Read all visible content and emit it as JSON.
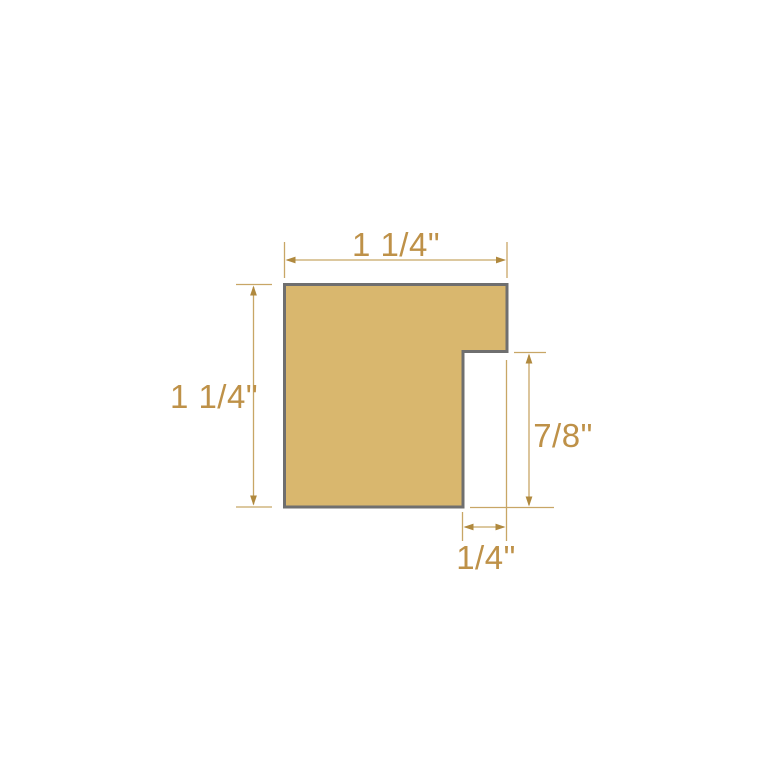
{
  "diagram": {
    "type": "frame-moulding-profile-cross-section",
    "units": "inches",
    "labels": {
      "width": "1 1/4\"",
      "height": "1 1/4\"",
      "rabbet_height": "7/8\"",
      "rabbet_width": "1/4\""
    },
    "measurements": {
      "width_in": 1.25,
      "height_in": 1.25,
      "rabbet_height_in": 0.875,
      "rabbet_width_in": 0.25
    },
    "colors": {
      "background": "#FFFFFF",
      "shape_fill": "#D9B76E",
      "shape_border": "#6F6F6F",
      "dimension_line": "#C8A666",
      "dimension_arrow": "#B0893E",
      "dimension_text": "#BE9148"
    }
  }
}
